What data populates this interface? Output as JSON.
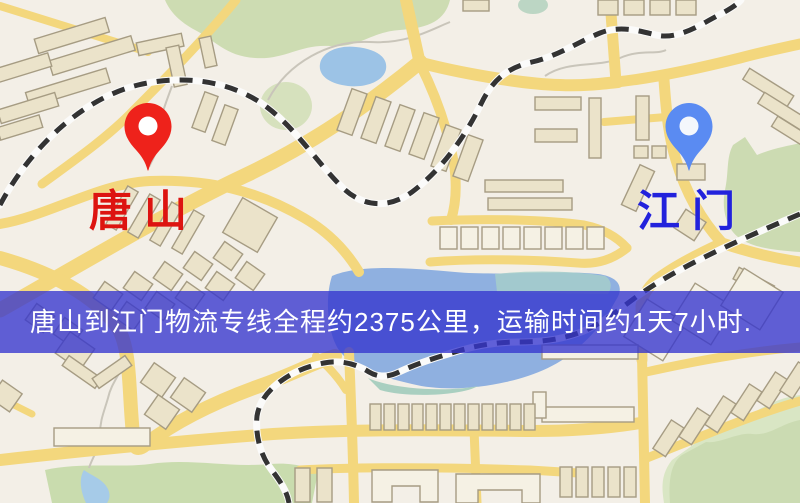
{
  "map": {
    "origin": {
      "label": "唐山",
      "marker_color": "#ee221b",
      "label_color": "#dd1410"
    },
    "destination": {
      "label": "江门",
      "marker_color": "#5a8bf2",
      "label_color": "#2222dc"
    },
    "banner": {
      "text": "唐山到江门物流专线全程约2375公里，运输时间约1天7小时.",
      "background_color": "#3535ce",
      "text_color": "#ffffff"
    },
    "palette": {
      "land": "#f3efe7",
      "road": "#f3d77d",
      "park": "#cddcb2",
      "water": "#9cc3e6",
      "railway": "#333333",
      "building": "#ebe3ca"
    }
  }
}
